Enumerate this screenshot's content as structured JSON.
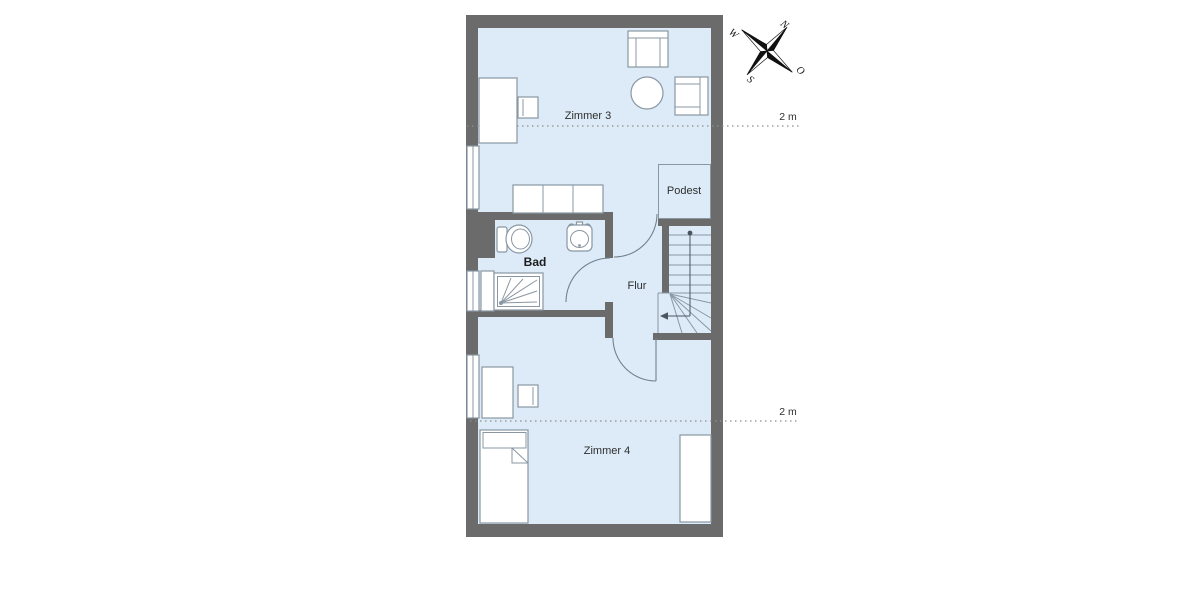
{
  "floorplan": {
    "rooms": [
      {
        "name": "zimmer-3",
        "label": "Zimmer 3"
      },
      {
        "name": "podest",
        "label": "Podest"
      },
      {
        "name": "bad",
        "label": "Bad"
      },
      {
        "name": "flur",
        "label": "Flur"
      },
      {
        "name": "zimmer-4",
        "label": "Zimmer 4"
      }
    ],
    "dimension_markers": [
      {
        "label": "2 m"
      },
      {
        "label": "2 m"
      }
    ],
    "compass": {
      "n": "N",
      "o": "O",
      "s": "S",
      "w": "W"
    },
    "furniture": [
      {
        "name": "desk",
        "room": "zimmer-3"
      },
      {
        "name": "chair",
        "room": "zimmer-3"
      },
      {
        "name": "armchair-top",
        "room": "zimmer-3"
      },
      {
        "name": "round-table",
        "room": "zimmer-3"
      },
      {
        "name": "armchair-right",
        "room": "zimmer-3"
      },
      {
        "name": "sofa",
        "room": "zimmer-3"
      },
      {
        "name": "toilet",
        "room": "bad"
      },
      {
        "name": "sink",
        "room": "bad"
      },
      {
        "name": "shower",
        "room": "bad"
      },
      {
        "name": "cabinet",
        "room": "bad"
      },
      {
        "name": "desk",
        "room": "zimmer-4"
      },
      {
        "name": "chair",
        "room": "zimmer-4"
      },
      {
        "name": "bed-left",
        "room": "zimmer-4"
      },
      {
        "name": "bed-right",
        "room": "zimmer-4"
      },
      {
        "name": "staircase-with-winders",
        "room": "podest"
      }
    ],
    "colors": {
      "wall": "#6b6b6b",
      "floor": "#dcebf7",
      "furniture_line": "#8997a3",
      "door_arc": "#70808d",
      "dotted_line": "#8e8e8e",
      "text": "#2e2e2e",
      "background": "#ffffff"
    }
  }
}
